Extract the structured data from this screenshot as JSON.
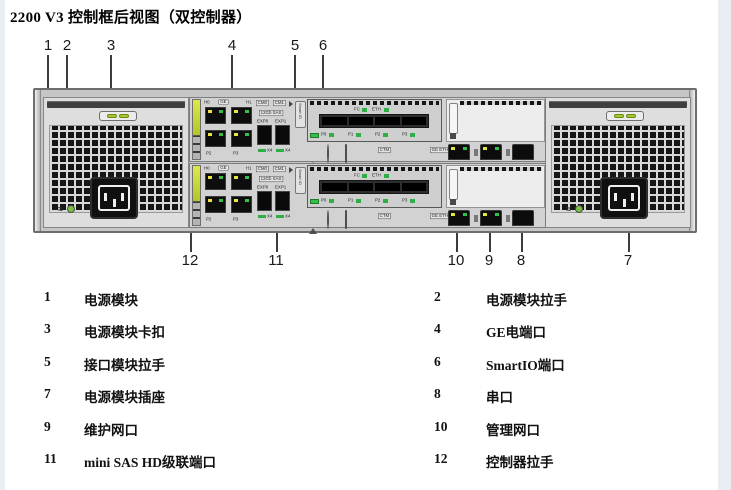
{
  "page": {
    "title": "2200 V3 控制框后视图（双控制器）"
  },
  "callouts": {
    "top": [
      "1",
      "2",
      "3",
      "4",
      "5",
      "6"
    ],
    "bottom": [
      "12",
      "11",
      "10",
      "9",
      "8",
      "7"
    ]
  },
  "diagram": {
    "controller": {
      "ge": {
        "h0": "H0",
        "badge": "GE",
        "h1": "H1",
        "p2": "P2",
        "p3": "P3"
      },
      "sas": {
        "cm0": "CM0",
        "cm1": "CM1",
        "speed": "12Gb SAS",
        "exp0": "EXP0",
        "exp1": "EXP1",
        "x4": "X4"
      },
      "smartio": {
        "tab": "Smart IO",
        "fc": "FC",
        "eth": "ETH",
        "ports": [
          "P0",
          "P1",
          "P2",
          "P3"
        ]
      },
      "status": {
        "ctm": "CTM",
        "ge_eth": "GE ETH"
      }
    },
    "psu": {
      "ac": "≈"
    }
  },
  "legend": {
    "rows": [
      {
        "num": "1",
        "label": "电源模块"
      },
      {
        "num": "2",
        "label": "电源模块拉手"
      },
      {
        "num": "3",
        "label": "电源模块卡扣"
      },
      {
        "num": "4",
        "label": "GE电端口"
      },
      {
        "num": "5",
        "label": "接口模块拉手"
      },
      {
        "num": "6",
        "label": "SmartIO端口"
      },
      {
        "num": "7",
        "label": "电源模块插座"
      },
      {
        "num": "8",
        "label": "串口"
      },
      {
        "num": "9",
        "label": "维护网口"
      },
      {
        "num": "10",
        "label": "管理网口"
      },
      {
        "num": "11",
        "label": "mini SAS HD级联端口"
      },
      {
        "num": "12",
        "label": "控制器拉手"
      }
    ]
  }
}
